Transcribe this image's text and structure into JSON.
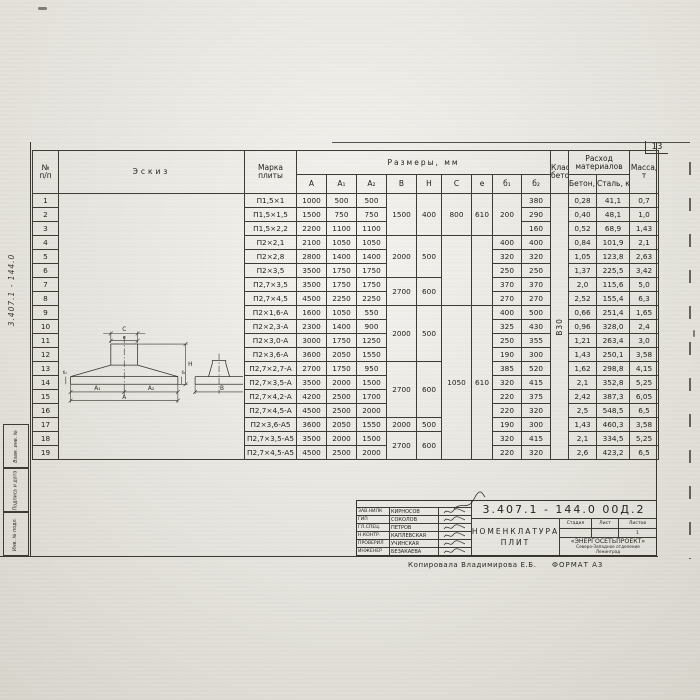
{
  "page": {
    "sheet_number": "13",
    "side_doc_number": "3.407.1 - 144.0",
    "edge_stamps": [
      "Взам. инв. №",
      "Подпись и дата",
      "Инв. № подл."
    ]
  },
  "table": {
    "headers": {
      "num_top": "№",
      "num_bottom": "п/п",
      "sketch": "Эскиз",
      "mark1": "Марка",
      "mark2": "плиты",
      "dims": "Размеры, мм",
      "dim_cols": [
        "A",
        "A₁",
        "A₂",
        "B",
        "H",
        "C",
        "е",
        "б₁",
        "б₂"
      ],
      "class1": "Класс",
      "class2": "бетона",
      "cons1": "Расход",
      "cons2": "материалов",
      "beton": "Бетон, м³",
      "stal": "Сталь, кг",
      "mass1": "Масса,",
      "mass2": "т"
    },
    "class_value": "В30",
    "rows": [
      {
        "n": "1",
        "mark": "П1,5×1",
        "A": "1000",
        "A1": "500",
        "A2": "500",
        "b2": "380",
        "beton": "0,28",
        "stal": "41,1",
        "massa": "0,7"
      },
      {
        "n": "2",
        "mark": "П1,5×1,5",
        "A": "1500",
        "A1": "750",
        "A2": "750",
        "b2": "290",
        "beton": "0,40",
        "stal": "48,1",
        "massa": "1,0"
      },
      {
        "n": "3",
        "mark": "П1,5×2,2",
        "A": "2200",
        "A1": "1100",
        "A2": "1100",
        "b2": "160",
        "beton": "0,52",
        "stal": "68,9",
        "massa": "1,43"
      },
      {
        "n": "4",
        "mark": "П2×2,1",
        "A": "2100",
        "A1": "1050",
        "A2": "1050",
        "b2": "400",
        "beton": "0,84",
        "stal": "101,9",
        "massa": "2,1"
      },
      {
        "n": "5",
        "mark": "П2×2,8",
        "A": "2800",
        "A1": "1400",
        "A2": "1400",
        "b2": "320",
        "beton": "1,05",
        "stal": "123,8",
        "massa": "2,63"
      },
      {
        "n": "6",
        "mark": "П2×3,5",
        "A": "3500",
        "A1": "1750",
        "A2": "1750",
        "b2": "250",
        "beton": "1,37",
        "stal": "225,5",
        "massa": "3,42"
      },
      {
        "n": "7",
        "mark": "П2,7×3,5",
        "A": "3500",
        "A1": "1750",
        "A2": "1750",
        "b2": "370",
        "beton": "2,0",
        "stal": "115,6",
        "massa": "5,0"
      },
      {
        "n": "8",
        "mark": "П2,7×4,5",
        "A": "4500",
        "A1": "2250",
        "A2": "2250",
        "b2": "270",
        "beton": "2,52",
        "stal": "155,4",
        "massa": "6,3"
      },
      {
        "n": "9",
        "mark": "П2×1,6-А",
        "A": "1600",
        "A1": "1050",
        "A2": "550",
        "b2": "500",
        "beton": "0,66",
        "stal": "251,4",
        "massa": "1,65"
      },
      {
        "n": "10",
        "mark": "П2×2,3-А",
        "A": "2300",
        "A1": "1400",
        "A2": "900",
        "b2": "430",
        "beton": "0,96",
        "stal": "328,0",
        "massa": "2,4"
      },
      {
        "n": "11",
        "mark": "П2×3,0-А",
        "A": "3000",
        "A1": "1750",
        "A2": "1250",
        "b2": "355",
        "beton": "1,21",
        "stal": "263,4",
        "massa": "3,0"
      },
      {
        "n": "12",
        "mark": "П2×3,6-А",
        "A": "3600",
        "A1": "2050",
        "A2": "1550",
        "b2": "300",
        "beton": "1,43",
        "stal": "250,1",
        "massa": "3,58"
      },
      {
        "n": "13",
        "mark": "П2,7×2,7-А",
        "A": "2700",
        "A1": "1750",
        "A2": "950",
        "b2": "520",
        "beton": "1,62",
        "stal": "298,8",
        "massa": "4,15"
      },
      {
        "n": "14",
        "mark": "П2,7×3,5-А",
        "A": "3500",
        "A1": "2000",
        "A2": "1500",
        "b2": "415",
        "beton": "2,1",
        "stal": "352,8",
        "massa": "5,25"
      },
      {
        "n": "15",
        "mark": "П2,7×4,2-А",
        "A": "4200",
        "A1": "2500",
        "A2": "1700",
        "b2": "375",
        "beton": "2,42",
        "stal": "387,3",
        "massa": "6,05"
      },
      {
        "n": "16",
        "mark": "П2,7×4,5-А",
        "A": "4500",
        "A1": "2500",
        "A2": "2000",
        "b2": "320",
        "beton": "2,5",
        "stal": "548,5",
        "massa": "6,5"
      },
      {
        "n": "17",
        "mark": "П2×3,6-А5",
        "A": "3600",
        "A1": "2050",
        "A2": "1550",
        "b2": "300",
        "beton": "1,43",
        "stal": "460,3",
        "massa": "3,58"
      },
      {
        "n": "18",
        "mark": "П2,7×3,5-А5",
        "A": "3500",
        "A1": "2000",
        "A2": "1500",
        "b2": "415",
        "beton": "2,1",
        "stal": "334,5",
        "massa": "5,25"
      },
      {
        "n": "19",
        "mark": "П2,7×4,5-А5",
        "A": "4500",
        "A1": "2500",
        "A2": "2000",
        "b2": "320",
        "beton": "2,6",
        "stal": "423,2",
        "massa": "6,5"
      }
    ],
    "merged": {
      "B": [
        {
          "f": 1,
          "t": 3,
          "v": "1500"
        },
        {
          "f": 4,
          "t": 6,
          "v": "2000"
        },
        {
          "f": 7,
          "t": 8,
          "v": "2700"
        },
        {
          "f": 9,
          "t": 12,
          "v": "2000"
        },
        {
          "f": 13,
          "t": 16,
          "v": "2700"
        },
        {
          "f": 17,
          "t": 17,
          "v": "2000"
        },
        {
          "f": 18,
          "t": 19,
          "v": "2700"
        }
      ],
      "H": [
        {
          "f": 1,
          "t": 3,
          "v": "400"
        },
        {
          "f": 4,
          "t": 6,
          "v": "500"
        },
        {
          "f": 7,
          "t": 8,
          "v": "600"
        },
        {
          "f": 9,
          "t": 12,
          "v": "500"
        },
        {
          "f": 13,
          "t": 16,
          "v": "600"
        },
        {
          "f": 17,
          "t": 17,
          "v": "500"
        },
        {
          "f": 18,
          "t": 19,
          "v": "600"
        }
      ],
      "C": [
        {
          "f": 1,
          "t": 3,
          "v": "800"
        },
        {
          "f": 4,
          "t": 8,
          "v": ""
        },
        {
          "f": 9,
          "t": 19,
          "v": "1050"
        }
      ],
      "e": [
        {
          "f": 1,
          "t": 3,
          "v": "610"
        },
        {
          "f": 4,
          "t": 8,
          "v": ""
        },
        {
          "f": 9,
          "t": 19,
          "v": "610"
        }
      ],
      "b1": [
        {
          "f": 1,
          "t": 3,
          "v": "200"
        },
        {
          "f": 4,
          "t": 4,
          "v": "400"
        },
        {
          "f": 5,
          "t": 5,
          "v": "320"
        },
        {
          "f": 6,
          "t": 6,
          "v": "250"
        },
        {
          "f": 7,
          "t": 7,
          "v": "370"
        },
        {
          "f": 8,
          "t": 8,
          "v": "270"
        },
        {
          "f": 9,
          "t": 9,
          "v": "400"
        },
        {
          "f": 10,
          "t": 10,
          "v": "325"
        },
        {
          "f": 11,
          "t": 11,
          "v": "250"
        },
        {
          "f": 12,
          "t": 12,
          "v": "190"
        },
        {
          "f": 13,
          "t": 13,
          "v": "385"
        },
        {
          "f": 14,
          "t": 14,
          "v": "320"
        },
        {
          "f": 15,
          "t": 15,
          "v": "220"
        },
        {
          "f": 16,
          "t": 16,
          "v": "220"
        },
        {
          "f": 17,
          "t": 17,
          "v": "190"
        },
        {
          "f": 18,
          "t": 18,
          "v": "320"
        },
        {
          "f": 19,
          "t": 19,
          "v": "220"
        }
      ]
    }
  },
  "sketch": {
    "labels": {
      "c": "C",
      "e": "е",
      "a1": "A₁",
      "a2": "A₂",
      "a": "A",
      "h": "H",
      "b1": "б₁",
      "b2": "б₂",
      "b": "B",
      "t160": "160"
    }
  },
  "title_block": {
    "doc_number": "3.407.1 - 144.0  00Д.2",
    "title_line1": "Номенклатура",
    "title_line2": "плит",
    "signers": [
      {
        "role": "Зав.НИЛК",
        "name": "Кирносов"
      },
      {
        "role": "ГИП",
        "name": "Соколов"
      },
      {
        "role": "Гл.спец.",
        "name": "Петров"
      },
      {
        "role": "Н.контр.",
        "name": "Каплевская"
      },
      {
        "role": "Проверил",
        "name": "Учинская"
      },
      {
        "role": "Инженер",
        "name": "Безакаева"
      }
    ],
    "stage_headers": [
      "Стадия",
      "Лист",
      "Листов"
    ],
    "sheets_value": "1",
    "org_name": "«ЭНЕРГОСЕТЬПРОЕКТ»",
    "org_branch": "Северо-Западное отделение",
    "org_city": "Ленинград",
    "copy_note": "Копировала  Владимирова Е.Б.",
    "format_note": "ФОРМАТ А3"
  }
}
